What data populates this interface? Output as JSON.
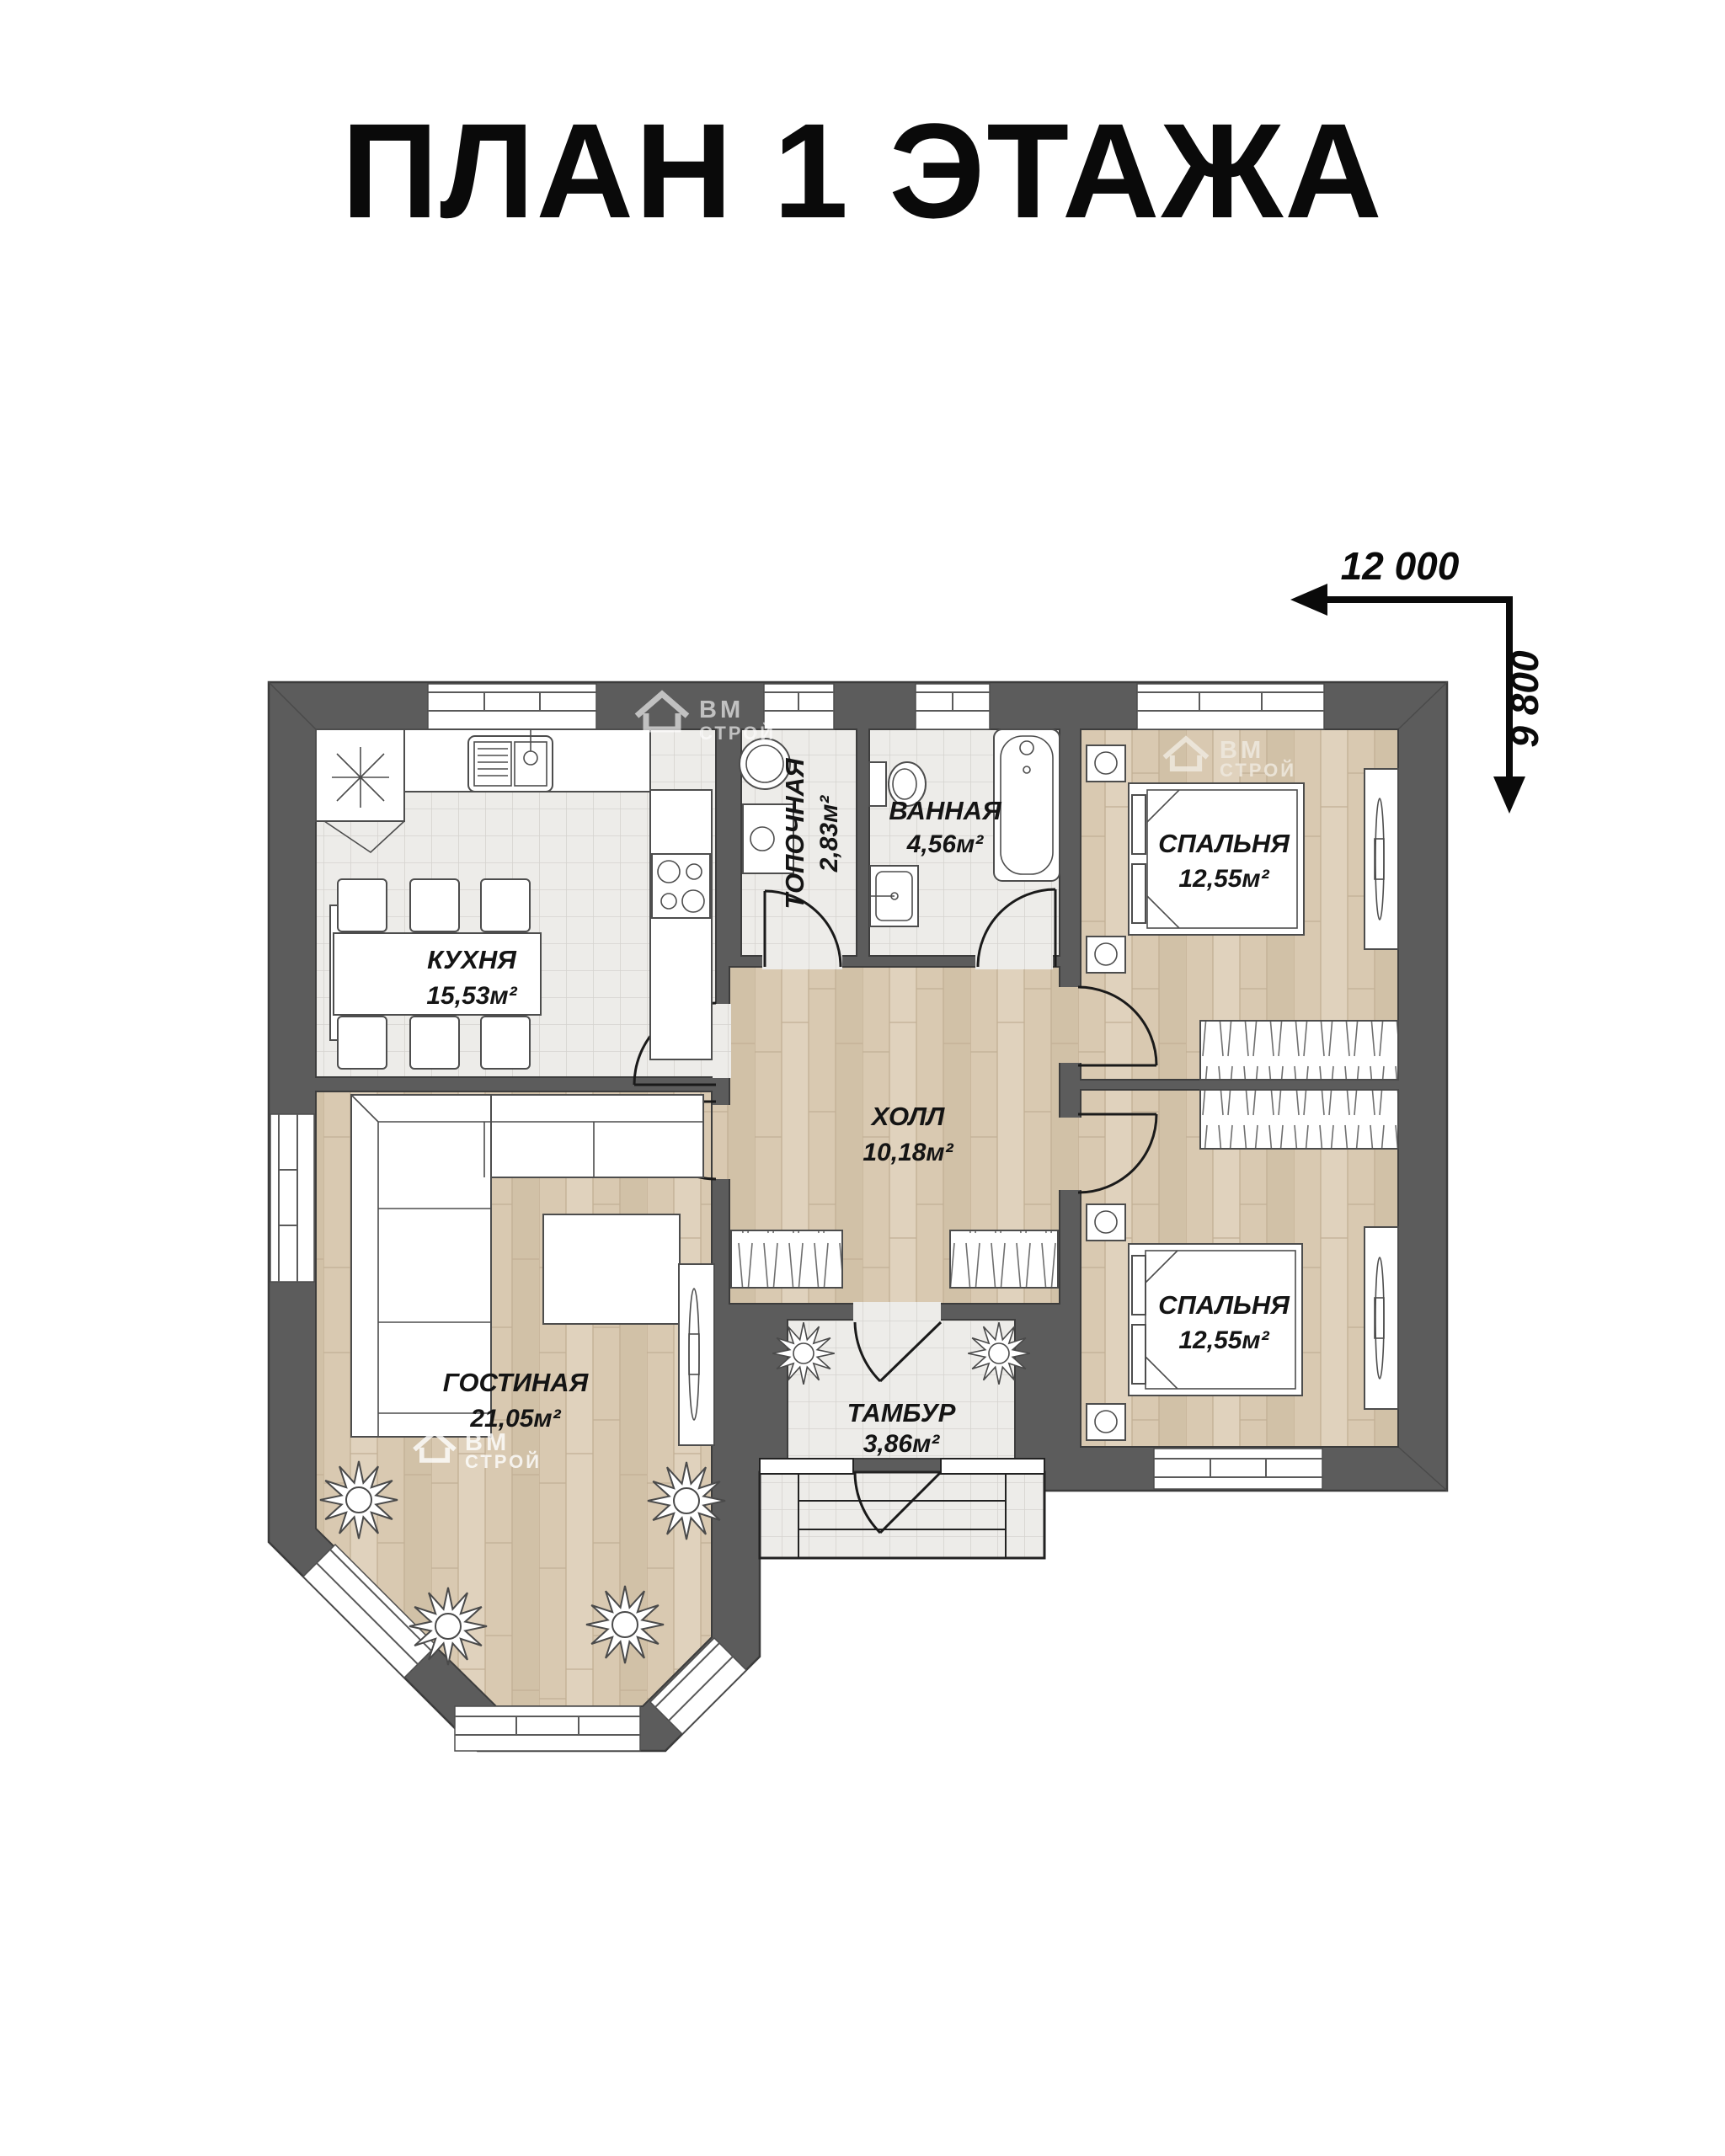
{
  "title": "ПЛАН 1 ЭТАЖА",
  "dimensions": {
    "width_label": "12 000",
    "height_label": "9 800"
  },
  "watermark": {
    "line1": "ВМ",
    "line2": "СТРОЙ"
  },
  "rooms": [
    {
      "id": "kitchen",
      "name": "КУХНЯ",
      "area": "15,53м²"
    },
    {
      "id": "boiler",
      "name": "ТОПОЧНАЯ",
      "area": "2,83м²"
    },
    {
      "id": "bathroom",
      "name": "ВАННАЯ",
      "area": "4,56м²"
    },
    {
      "id": "bedroom1",
      "name": "СПАЛЬНЯ",
      "area": "12,55м²"
    },
    {
      "id": "hall",
      "name": "ХОЛЛ",
      "area": "10,18м²"
    },
    {
      "id": "living",
      "name": "ГОСТИНАЯ",
      "area": "21,05м²"
    },
    {
      "id": "bedroom2",
      "name": "СПАЛЬНЯ",
      "area": "12,55м²"
    },
    {
      "id": "vestibule",
      "name": "ТАМБУР",
      "area": "3,86м²"
    }
  ],
  "colors": {
    "walls": "#5c5c5c",
    "wall_outline": "#3b3b3b",
    "wood_floor": "#d9c9b1",
    "tile_floor": "#edece9",
    "text": "#111111"
  }
}
